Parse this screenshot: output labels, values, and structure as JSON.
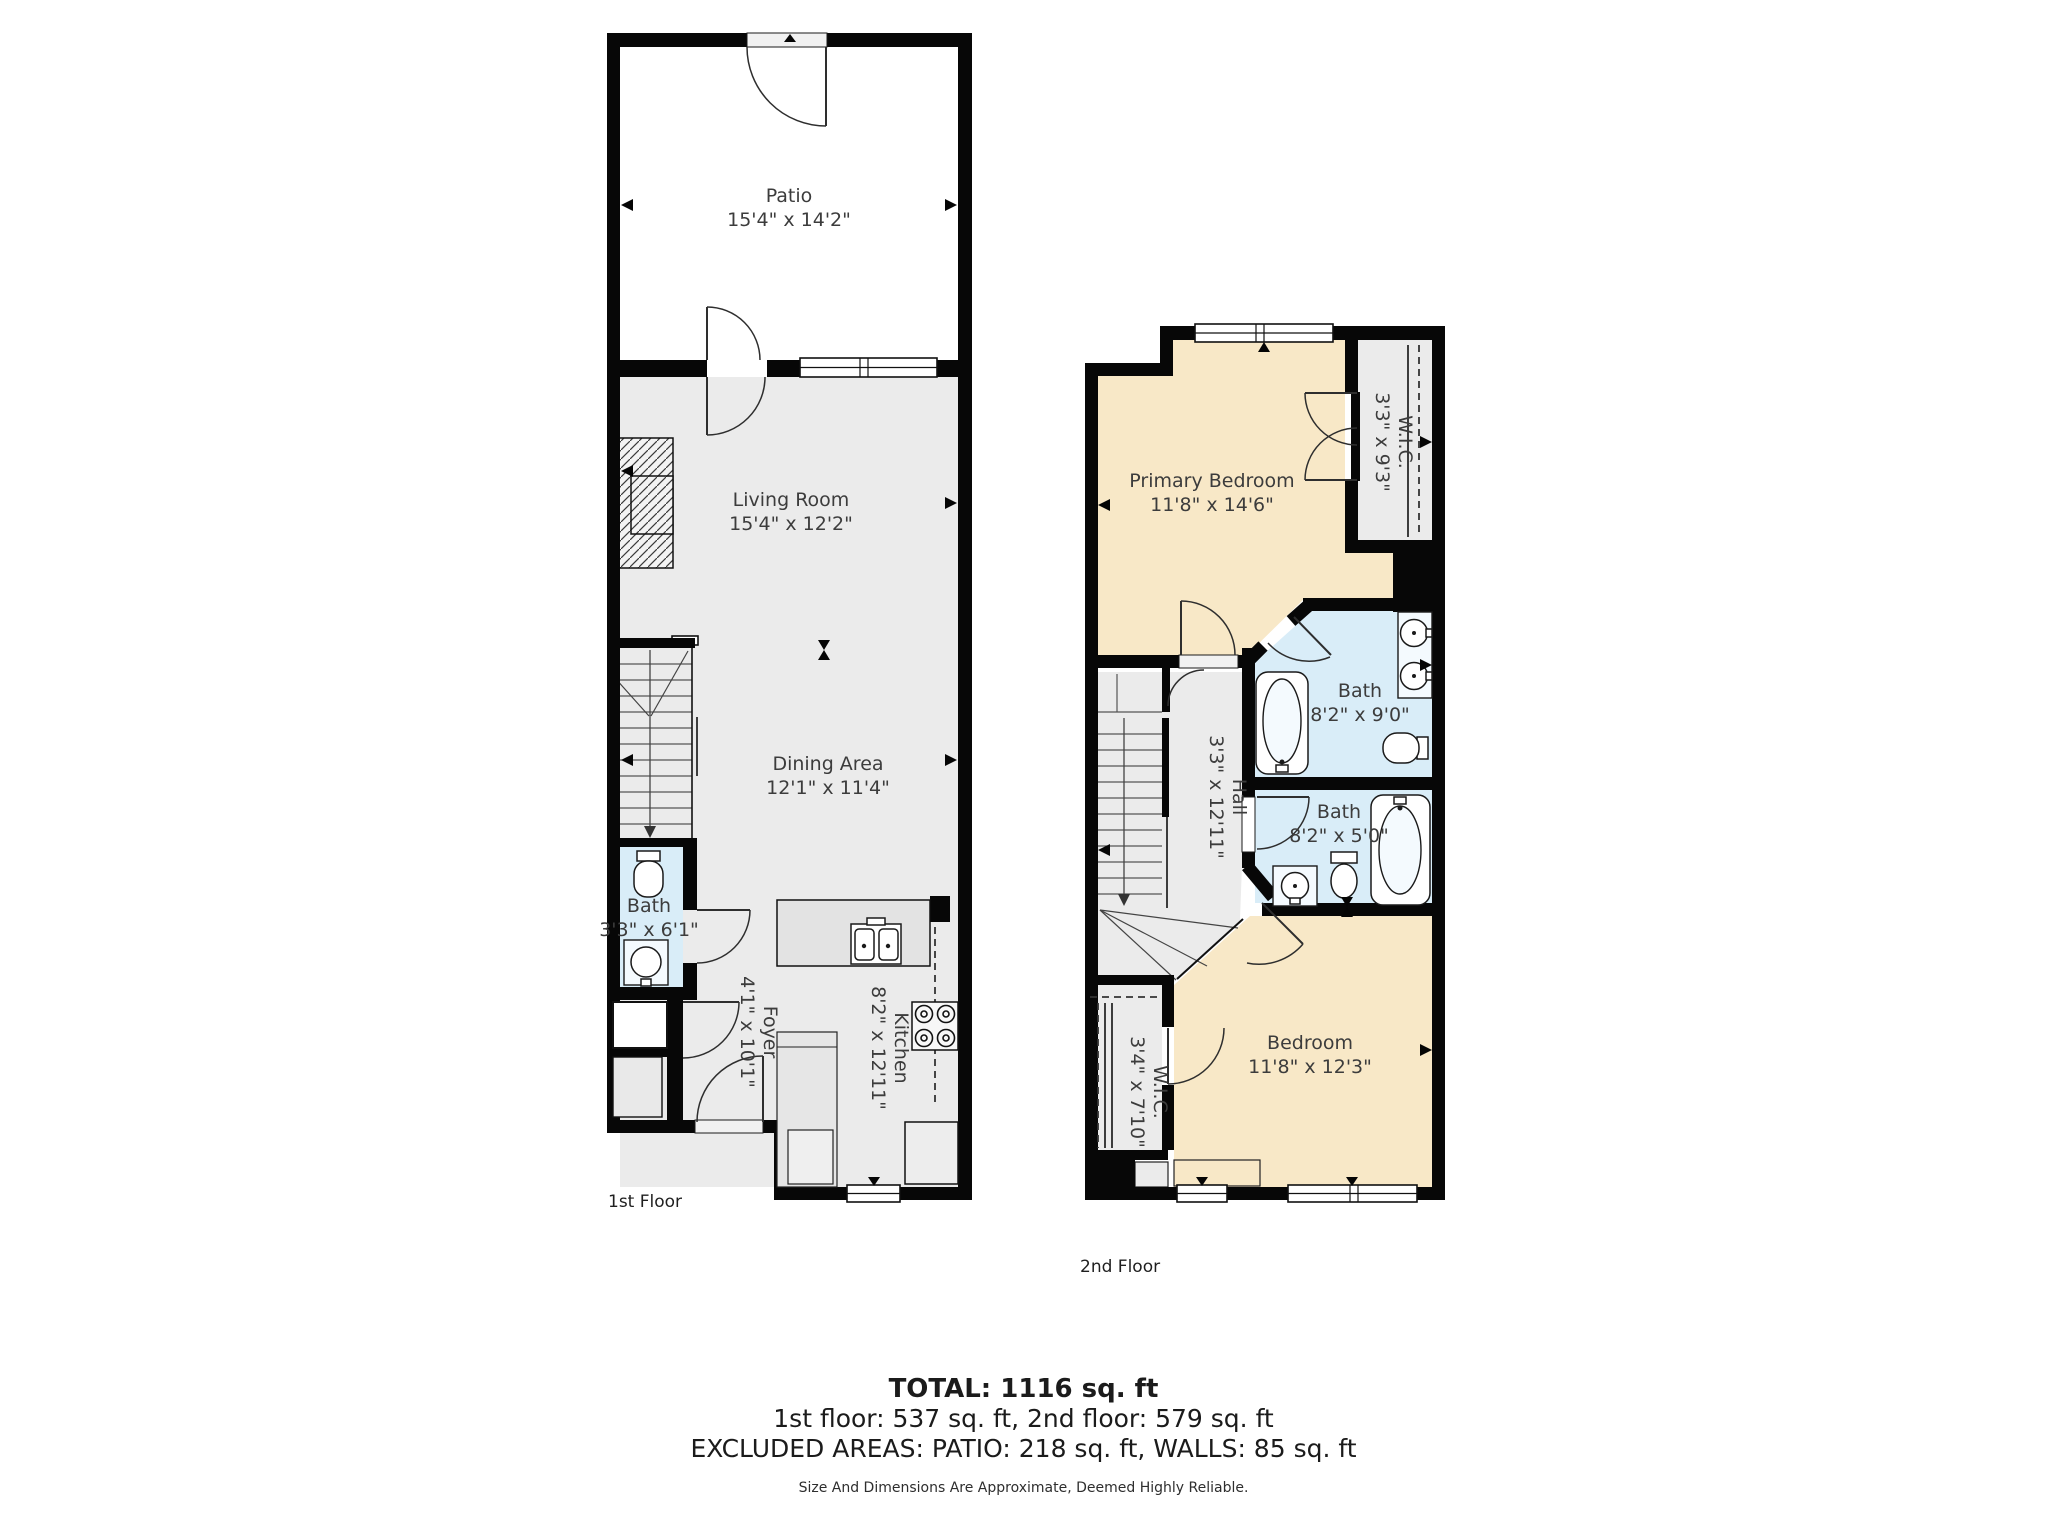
{
  "colors": {
    "wall": "#070707",
    "floor_gray": "#ebebeb",
    "bath_blue": "#d9edf8",
    "bedroom_cream": "#f8e8c7",
    "background": "#ffffff"
  },
  "floor1": {
    "label": "1st Floor",
    "rooms": {
      "patio": {
        "name": "Patio",
        "dims": "15'4\" x 14'2\""
      },
      "living_room": {
        "name": "Living Room",
        "dims": "15'4\" x 12'2\""
      },
      "dining_area": {
        "name": "Dining Area",
        "dims": "12'1\" x 11'4\""
      },
      "bath": {
        "name": "Bath",
        "dims": "3'3\" x 6'1\""
      },
      "foyer": {
        "name": "Foyer",
        "dims": "4'1\" x 10'1\""
      },
      "kitchen": {
        "name": "Kitchen",
        "dims": "8'2\" x 12'11\""
      }
    }
  },
  "floor2": {
    "label": "2nd Floor",
    "rooms": {
      "primary_bedroom": {
        "name": "Primary Bedroom",
        "dims": "11'8\" x 14'6\""
      },
      "wic_top": {
        "name": "W.I.C.",
        "dims": "3'3\" x 9'3\""
      },
      "bath_top": {
        "name": "Bath",
        "dims": "8'2\" x 9'0\""
      },
      "hall": {
        "name": "Hall",
        "dims": "3'3\" x 12'11\""
      },
      "bath_bottom": {
        "name": "Bath",
        "dims": "8'2\" x 5'0\""
      },
      "bedroom": {
        "name": "Bedroom",
        "dims": "11'8\" x 12'3\""
      },
      "wic_bottom": {
        "name": "W.I.C.",
        "dims": "3'4\" x 7'10\""
      }
    }
  },
  "summary": {
    "total": "TOTAL: 1116 sq. ft",
    "floors": "1st floor: 537 sq. ft, 2nd floor: 579 sq. ft",
    "excluded": "EXCLUDED AREAS: PATIO: 218 sq. ft, WALLS: 85 sq. ft",
    "disclaimer": "Size And Dimensions Are Approximate, Deemed Highly Reliable."
  }
}
